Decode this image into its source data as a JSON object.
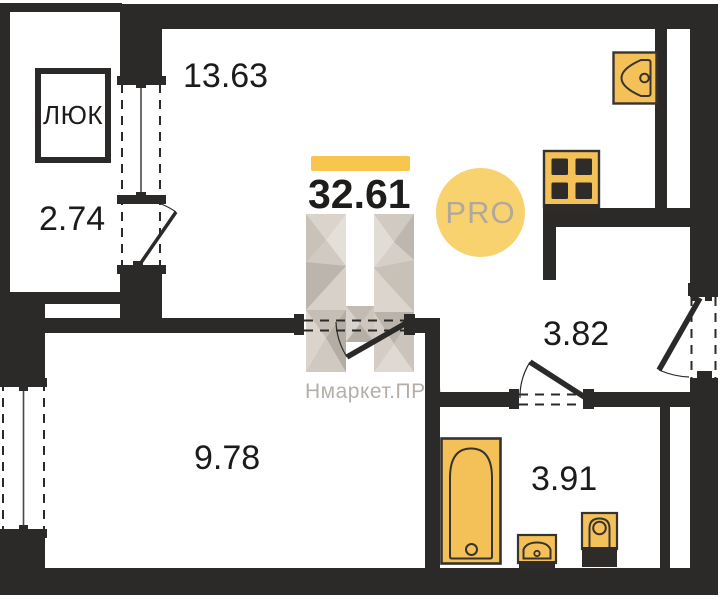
{
  "floor_plan": {
    "total_area": "32.61",
    "badge": "PRO",
    "brand": "Нмаркет.ПРО",
    "hatch": "ЛЮК",
    "rooms": [
      {
        "name": "living-kitchen",
        "area": "13.63"
      },
      {
        "name": "balcony",
        "area": "2.74"
      },
      {
        "name": "hallway",
        "area": "3.82"
      },
      {
        "name": "room",
        "area": "9.78"
      },
      {
        "name": "bathroom",
        "area": "3.91"
      }
    ],
    "colors": {
      "wall": "#2b2a29",
      "fixture_fill": "#f4c158",
      "fixture_stroke": "#38332f",
      "accent_bar": "#f8c54d",
      "badge_bg": "#f8d26e",
      "badge_text": "#b2a89a",
      "watermark": "#cbc4bc"
    }
  }
}
